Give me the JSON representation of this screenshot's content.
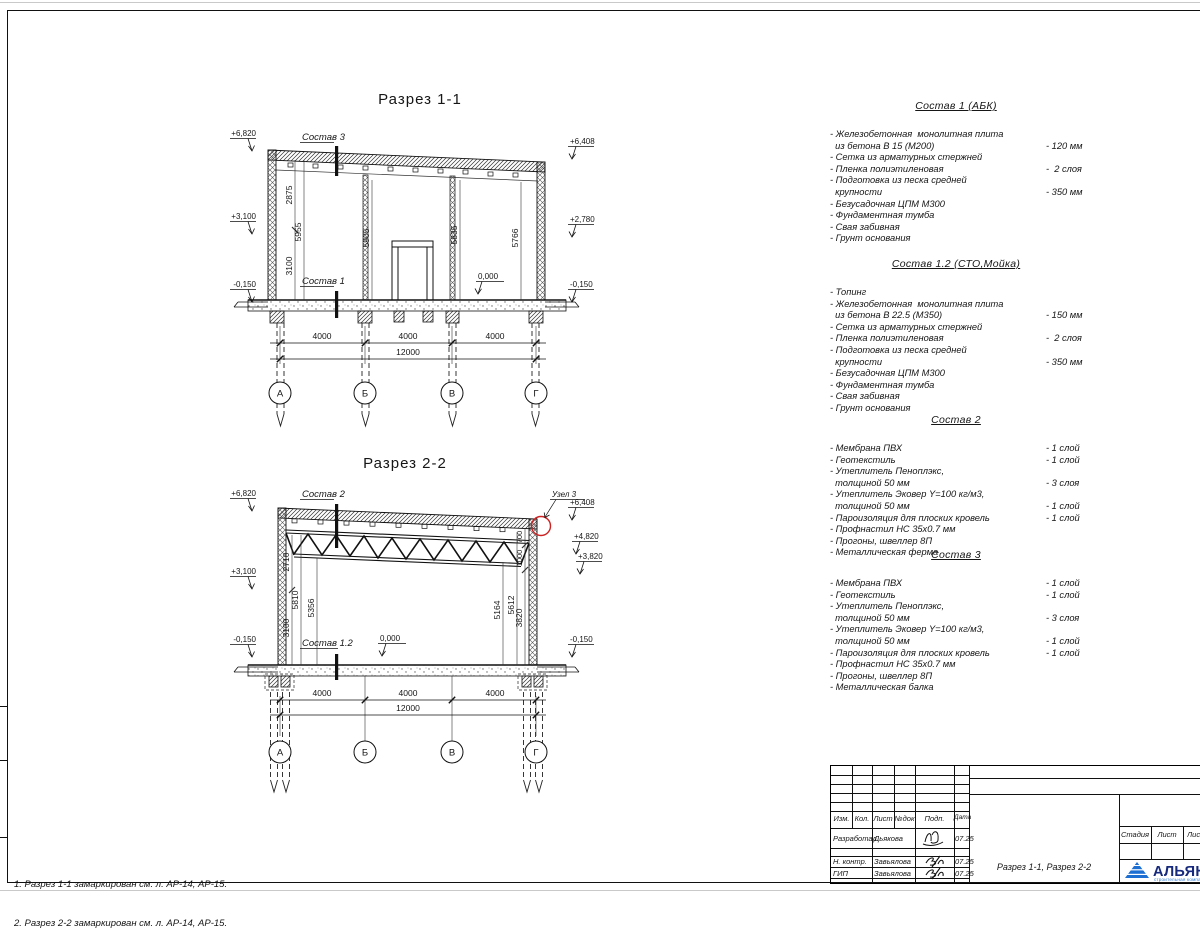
{
  "section1": {
    "title": "Разрез 1-1",
    "label_top": "Состав 3",
    "label_floor": "Состав 1",
    "elev": {
      "l1": "+6,820",
      "l2": "+3,100",
      "l3": "-0,150",
      "r1": "+6,408",
      "r2": "+2,780",
      "r3": "-0,150",
      "zero": "0,000"
    },
    "dims_v": {
      "d2875": "2875",
      "d3100": "3100",
      "d5955": "5955",
      "d5905": "5905",
      "d5835": "5835",
      "d5766": "5766"
    },
    "dims_bottom": [
      "4000",
      "4000",
      "4000"
    ],
    "dim_total": "12000",
    "axes": [
      "А",
      "Б",
      "В",
      "Г"
    ]
  },
  "section2": {
    "title": "Разрез 2-2",
    "label_top": "Состав 2",
    "label_floor": "Состав 1.2",
    "node": "Узел 3",
    "elev": {
      "l1": "+6,820",
      "l2": "+3,100",
      "l3": "-0,150",
      "r1": "+6,408",
      "r2": "+4,820",
      "r3": "+3,820",
      "r4": "-0,150",
      "zero": "0,000"
    },
    "dims_v": {
      "d2710": "2710",
      "d3100": "3100",
      "d5810": "5810",
      "d5356": "5356",
      "d5164": "5164",
      "d5612": "5612",
      "d700": "700",
      "d1000": "1000",
      "d3820": "3820"
    },
    "dims_bottom": [
      "4000",
      "4000",
      "4000"
    ],
    "dim_total": "12000",
    "axes": [
      "А",
      "Б",
      "В",
      "Г"
    ]
  },
  "specs": [
    {
      "title": "Состав 1 (АБК)",
      "items": [
        {
          "t": "- Железобетонная  монолитная плита",
          "v": ""
        },
        {
          "t": "  из бетона В 15 (М200)",
          "v": "- 120 мм"
        },
        {
          "t": "- Сетка из арматурных стержней",
          "v": ""
        },
        {
          "t": "- Пленка полиэтиленовая",
          "v": "-  2 слоя"
        },
        {
          "t": "- Подготовка из песка средней",
          "v": ""
        },
        {
          "t": "  крупности",
          "v": "- 350 мм"
        },
        {
          "t": "- Безусадочная ЦПМ М300",
          "v": ""
        },
        {
          "t": "- Фундаментная тумба",
          "v": ""
        },
        {
          "t": "- Свая забивная",
          "v": ""
        },
        {
          "t": "- Грунт основания",
          "v": ""
        }
      ]
    },
    {
      "title": "Состав 1.2 (СТО,Мойка)",
      "items": [
        {
          "t": "- Топинг",
          "v": ""
        },
        {
          "t": "- Железобетонная  монолитная плита",
          "v": ""
        },
        {
          "t": "  из бетона В 22.5 (М350)",
          "v": "- 150 мм"
        },
        {
          "t": "- Сетка из арматурных стержней",
          "v": ""
        },
        {
          "t": "- Пленка полиэтиленовая",
          "v": "-  2 слоя"
        },
        {
          "t": "- Подготовка из песка средней",
          "v": ""
        },
        {
          "t": "  крупности",
          "v": "- 350 мм"
        },
        {
          "t": "- Безусадочная ЦПМ М300",
          "v": ""
        },
        {
          "t": "- Фундаментная тумба",
          "v": ""
        },
        {
          "t": "- Свая забивная",
          "v": ""
        },
        {
          "t": "- Грунт основания",
          "v": ""
        }
      ]
    },
    {
      "title": "Состав 2",
      "items": [
        {
          "t": "- Мембрана ПВХ",
          "v": "- 1 слой"
        },
        {
          "t": "- Геотекстиль",
          "v": "- 1 слой"
        },
        {
          "t": "- Утеплитель Пеноплэкс,",
          "v": ""
        },
        {
          "t": "  толщиной 50 мм",
          "v": "- 3 слоя"
        },
        {
          "t": "- Утеплитель Эковер Y=100 кг/м3,",
          "v": ""
        },
        {
          "t": "  толщиной 50 мм",
          "v": "- 1 слой"
        },
        {
          "t": "- Пароизоляция для плоских кровель",
          "v": "- 1 слой"
        },
        {
          "t": "- Профнастил НС 35х0.7 мм",
          "v": ""
        },
        {
          "t": "- Прогоны, швеллер 8П",
          "v": ""
        },
        {
          "t": "- Металлическая ферма",
          "v": ""
        }
      ]
    },
    {
      "title": "Состав 3",
      "items": [
        {
          "t": "- Мембрана ПВХ",
          "v": "- 1 слой"
        },
        {
          "t": "- Геотекстиль",
          "v": "- 1 слой"
        },
        {
          "t": "- Утеплитель Пеноплэкс,",
          "v": ""
        },
        {
          "t": "  толщиной 50 мм",
          "v": "- 3 слоя"
        },
        {
          "t": "- Утеплитель Эковер Y=100 кг/м3,",
          "v": ""
        },
        {
          "t": "  толщиной 50 мм",
          "v": "- 1 слой"
        },
        {
          "t": "- Пароизоляция для плоских кровель",
          "v": "- 1 слой"
        },
        {
          "t": "- Профнастил НС 35х0.7 мм",
          "v": ""
        },
        {
          "t": "- Прогоны, швеллер 8П",
          "v": ""
        },
        {
          "t": "- Металлическая балка",
          "v": ""
        }
      ]
    }
  ],
  "notes": [
    "1. Разрез 1-1 замаркирован см. л. АР-14, АР-15.",
    "2. Разрез 2-2 замаркирован см. л. АР-14, АР-15."
  ],
  "titleblock": {
    "cols": [
      "Изм.",
      "Кол.",
      "Лист",
      "№док",
      "Подп.",
      "Дата"
    ],
    "rows": [
      {
        "role": "Разработал",
        "name": "Дьякова",
        "date": "07.25"
      },
      {
        "role": "Н. контр.",
        "name": "Завьялова",
        "date": "07.25"
      },
      {
        "role": "ГИП",
        "name": "Завьялова",
        "date": "07.25"
      }
    ],
    "stage_cols": [
      "Стадия",
      "Лист",
      "Листов"
    ],
    "doc_title": "Разрез 1-1, Разрез 2-2",
    "company": "АЛЬЯНС",
    "company_sub": "строительная компания",
    "accent_red": "#cc2222",
    "brand_blue": "#16297c",
    "logo_blue": "#1d6fd2"
  }
}
